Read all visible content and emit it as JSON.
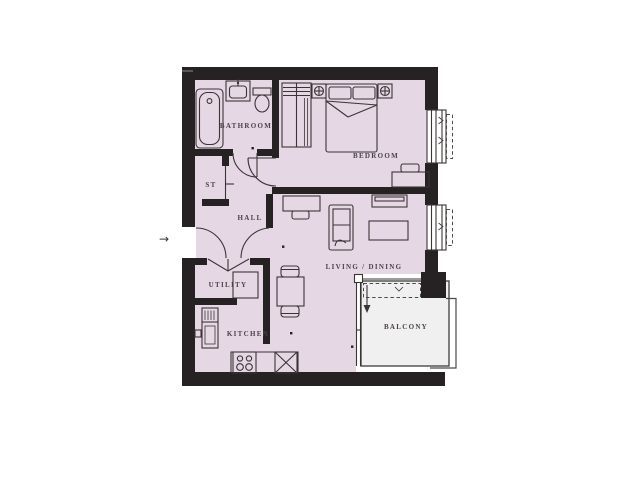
{
  "rooms": {
    "bathroom": "BATHROOM",
    "bedroom": "BEDROOM",
    "storage": "ST",
    "hall": "HALL",
    "utility": "UTILITY",
    "kitchen": "KITCHEN",
    "living_dining": "LIVING / DINING",
    "balcony": "BALCONY"
  },
  "entry_arrow": "→",
  "colors": {
    "wall": "#262123",
    "floor": "#e6d7e5",
    "balcony_floor": "#f1f0f1",
    "outline": "#3b3436",
    "label": "#4b4347",
    "railing": "#4a4a4a",
    "background": "#ffffff"
  }
}
